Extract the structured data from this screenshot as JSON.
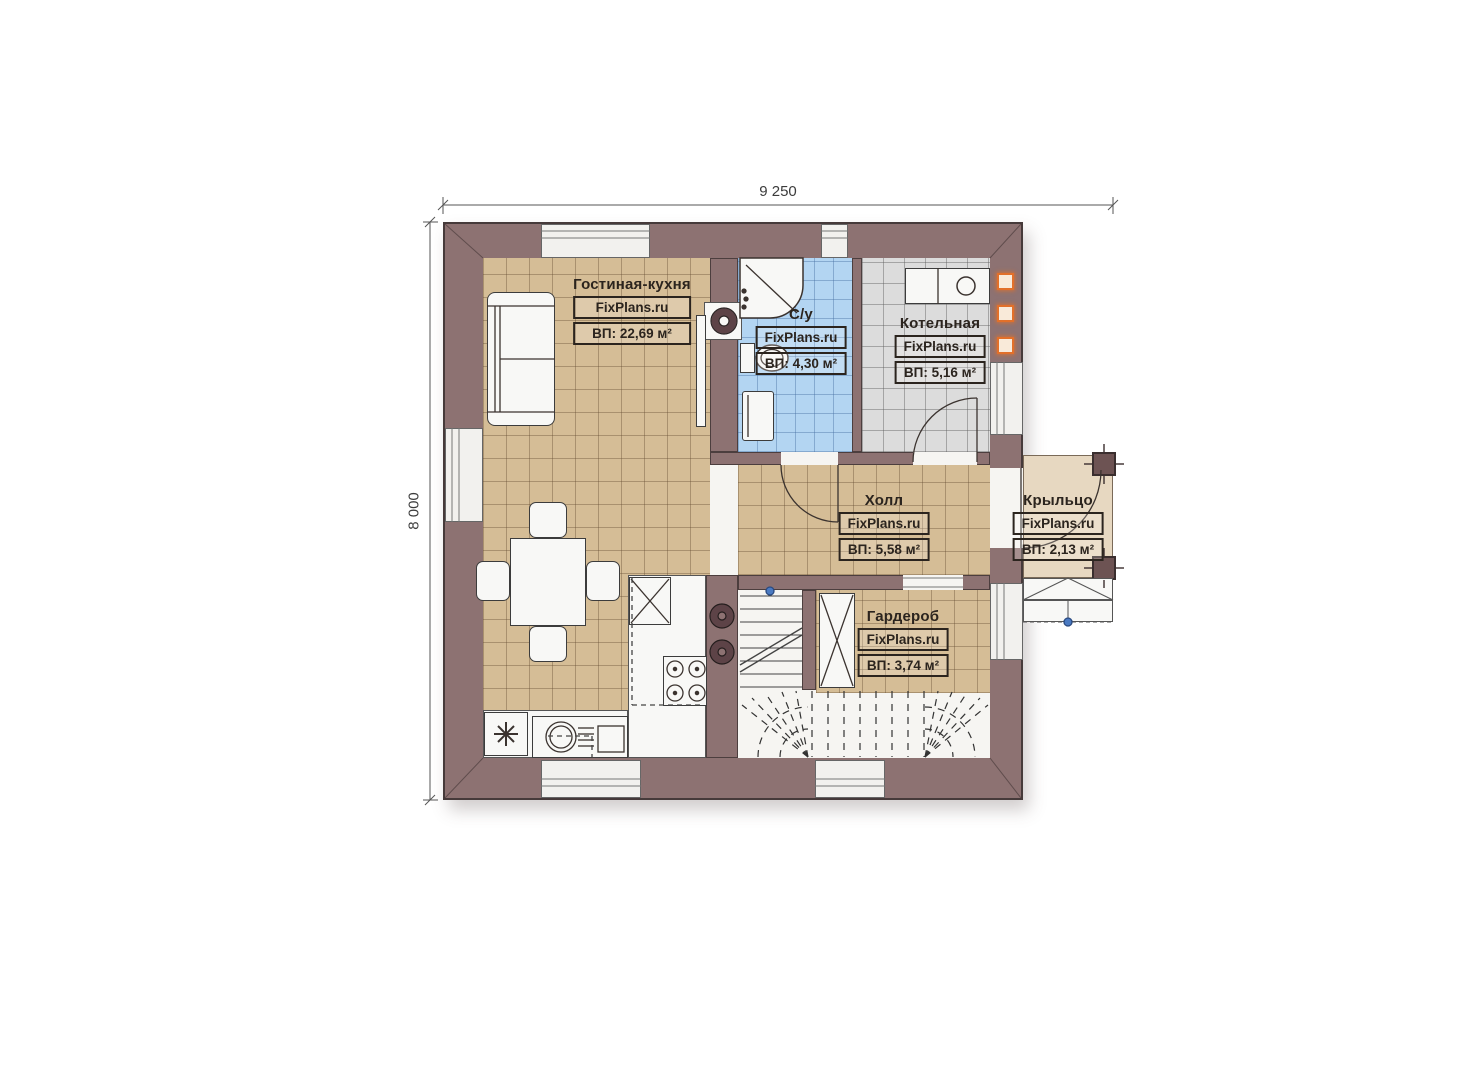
{
  "plan": {
    "watermark": "FixPlans.ru",
    "dimensions": {
      "width_label": "9 250",
      "height_label": "8 000"
    },
    "rooms": [
      {
        "name": "Гостиная-кухня",
        "brand": "FixPlans.ru",
        "area": "ВП: 22,69 м²"
      },
      {
        "name": "С/у",
        "brand": "FixPlans.ru",
        "area": "ВП: 4,30 м²"
      },
      {
        "name": "Котельная",
        "brand": "FixPlans.ru",
        "area": "ВП: 5,16 м²"
      },
      {
        "name": "Холл",
        "brand": "FixPlans.ru",
        "area": "ВП: 5,58 м²"
      },
      {
        "name": "Гардероб",
        "brand": "FixPlans.ru",
        "area": "ВП: 3,74 м²"
      },
      {
        "name": "Крыльцо",
        "brand": "FixPlans.ru",
        "area": "ВП: 2,13 м²"
      }
    ],
    "colors": {
      "wall": "#8d7272",
      "floor_wood": "#d5bd96",
      "floor_bath": "#b3d5f2",
      "floor_boiler": "#dcdcdc",
      "floor_porch": "#e7d8c1",
      "vent_accent": "#e2702a",
      "marker_blue": "#4a7ac2"
    }
  }
}
